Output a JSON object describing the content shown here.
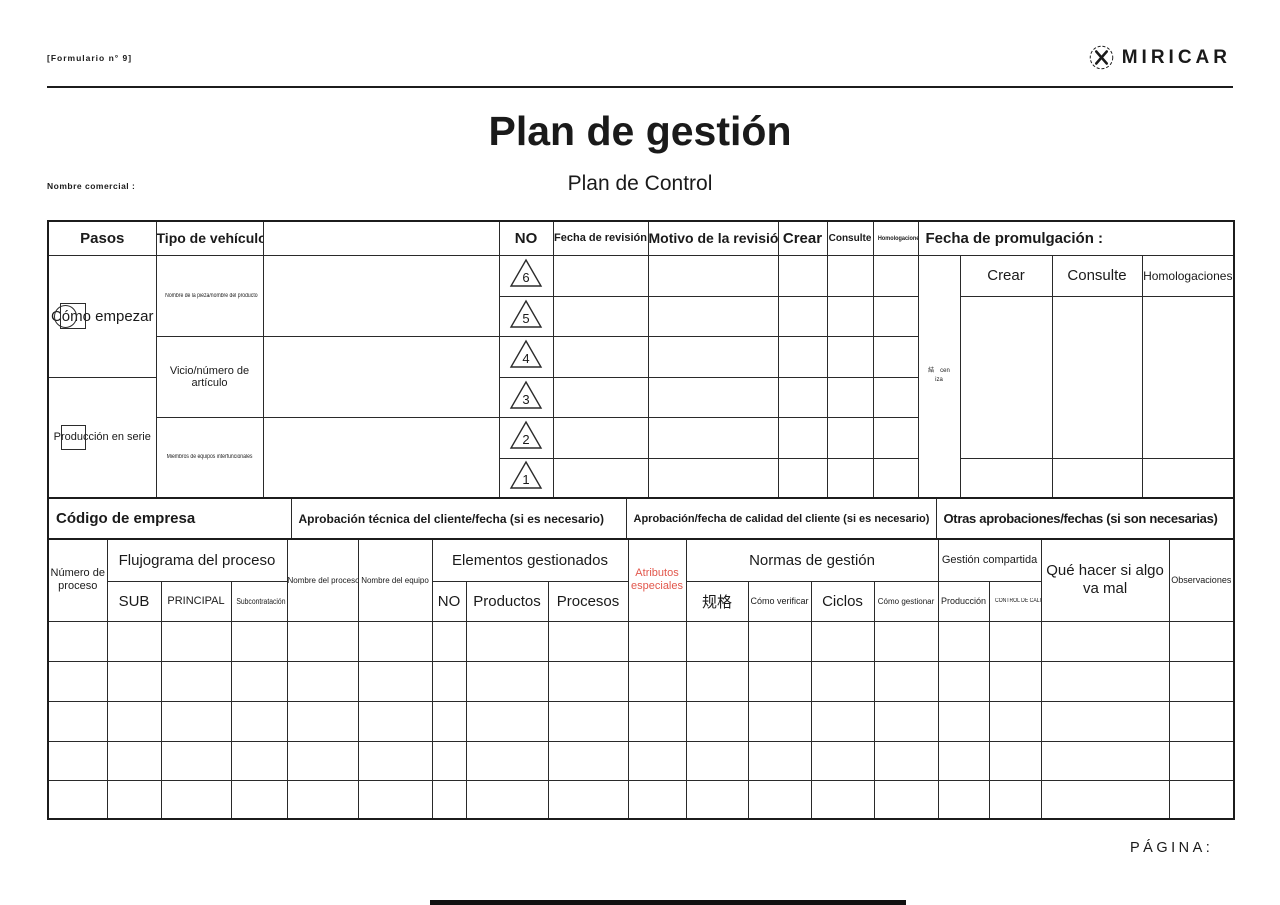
{
  "page": {
    "form_number": "[Formulario n° 9]",
    "brand_name": "MIRICAR",
    "title": "Plan de gestión",
    "trade_name_label": "Nombre comercial :",
    "subtitle": "Plan de Control",
    "page_label": "PÁGINA:",
    "colors": {
      "special_attribute_red": "#e2574c",
      "line_dark": "#1c1c1c"
    }
  },
  "revision_table": {
    "col_pasos": "Pasos",
    "col_vehicle_type": "Tipo de vehículo",
    "col_no": "NO",
    "col_revision_date": "Fecha de revisión",
    "col_revision_reason": "Motivo de la revisión",
    "col_create": "Crear",
    "col_consult": "Consulte",
    "col_homologations": "Homologaciones",
    "col_promulgation_date": "Fecha de promulgación :",
    "steps": [
      {
        "label": "Cómo empezar"
      },
      {
        "label": "Producción en serie"
      }
    ],
    "vehicle_rows": [
      "Nombre de la pieza/nombre del producto",
      "Vicio/número de artículo",
      "Miembros de equipos interfuncionales"
    ],
    "no_markers": [
      "6",
      "5",
      "4",
      "3",
      "2",
      "1"
    ],
    "vertical_note": {
      "char": "結",
      "part1": "cen",
      "part2": "iza"
    },
    "approval_header": {
      "create": "Crear",
      "consult": "Consulte",
      "homologations": "Homologaciones"
    }
  },
  "approval_row": {
    "company_code": "Código de empresa",
    "tech_approval": "Aprobación técnica del cliente/fecha (si es necesario)",
    "quality_approval": "Aprobación/fecha de calidad del cliente (si es necesario)",
    "other_approvals": "Otras aprobaciones/fechas (si son necesarias)"
  },
  "process_table": {
    "process_number": "Número de proceso",
    "flowchart": "Flujograma del proceso",
    "flowchart_sub": [
      "SUB",
      "PRINCIPAL",
      "Subcontratación"
    ],
    "process_name": "Nombre del proceso",
    "equipment_name": "Nombre del equipo",
    "managed_elements": "Elementos gestionados",
    "managed_sub": [
      "NO",
      "Productos",
      "Procesos"
    ],
    "special_attributes": "Atributos especiales",
    "management_standards": "Normas de gestión",
    "standards_sub": [
      "规格",
      "Cómo verificar",
      "Ciclos",
      "Cómo gestionar"
    ],
    "shared_management": "Gestión compartida",
    "shared_sub": [
      "Producción",
      "CONTROL DE CALIDAD"
    ],
    "contingency": "Qué hacer si algo va mal",
    "observations": "Observaciones"
  }
}
